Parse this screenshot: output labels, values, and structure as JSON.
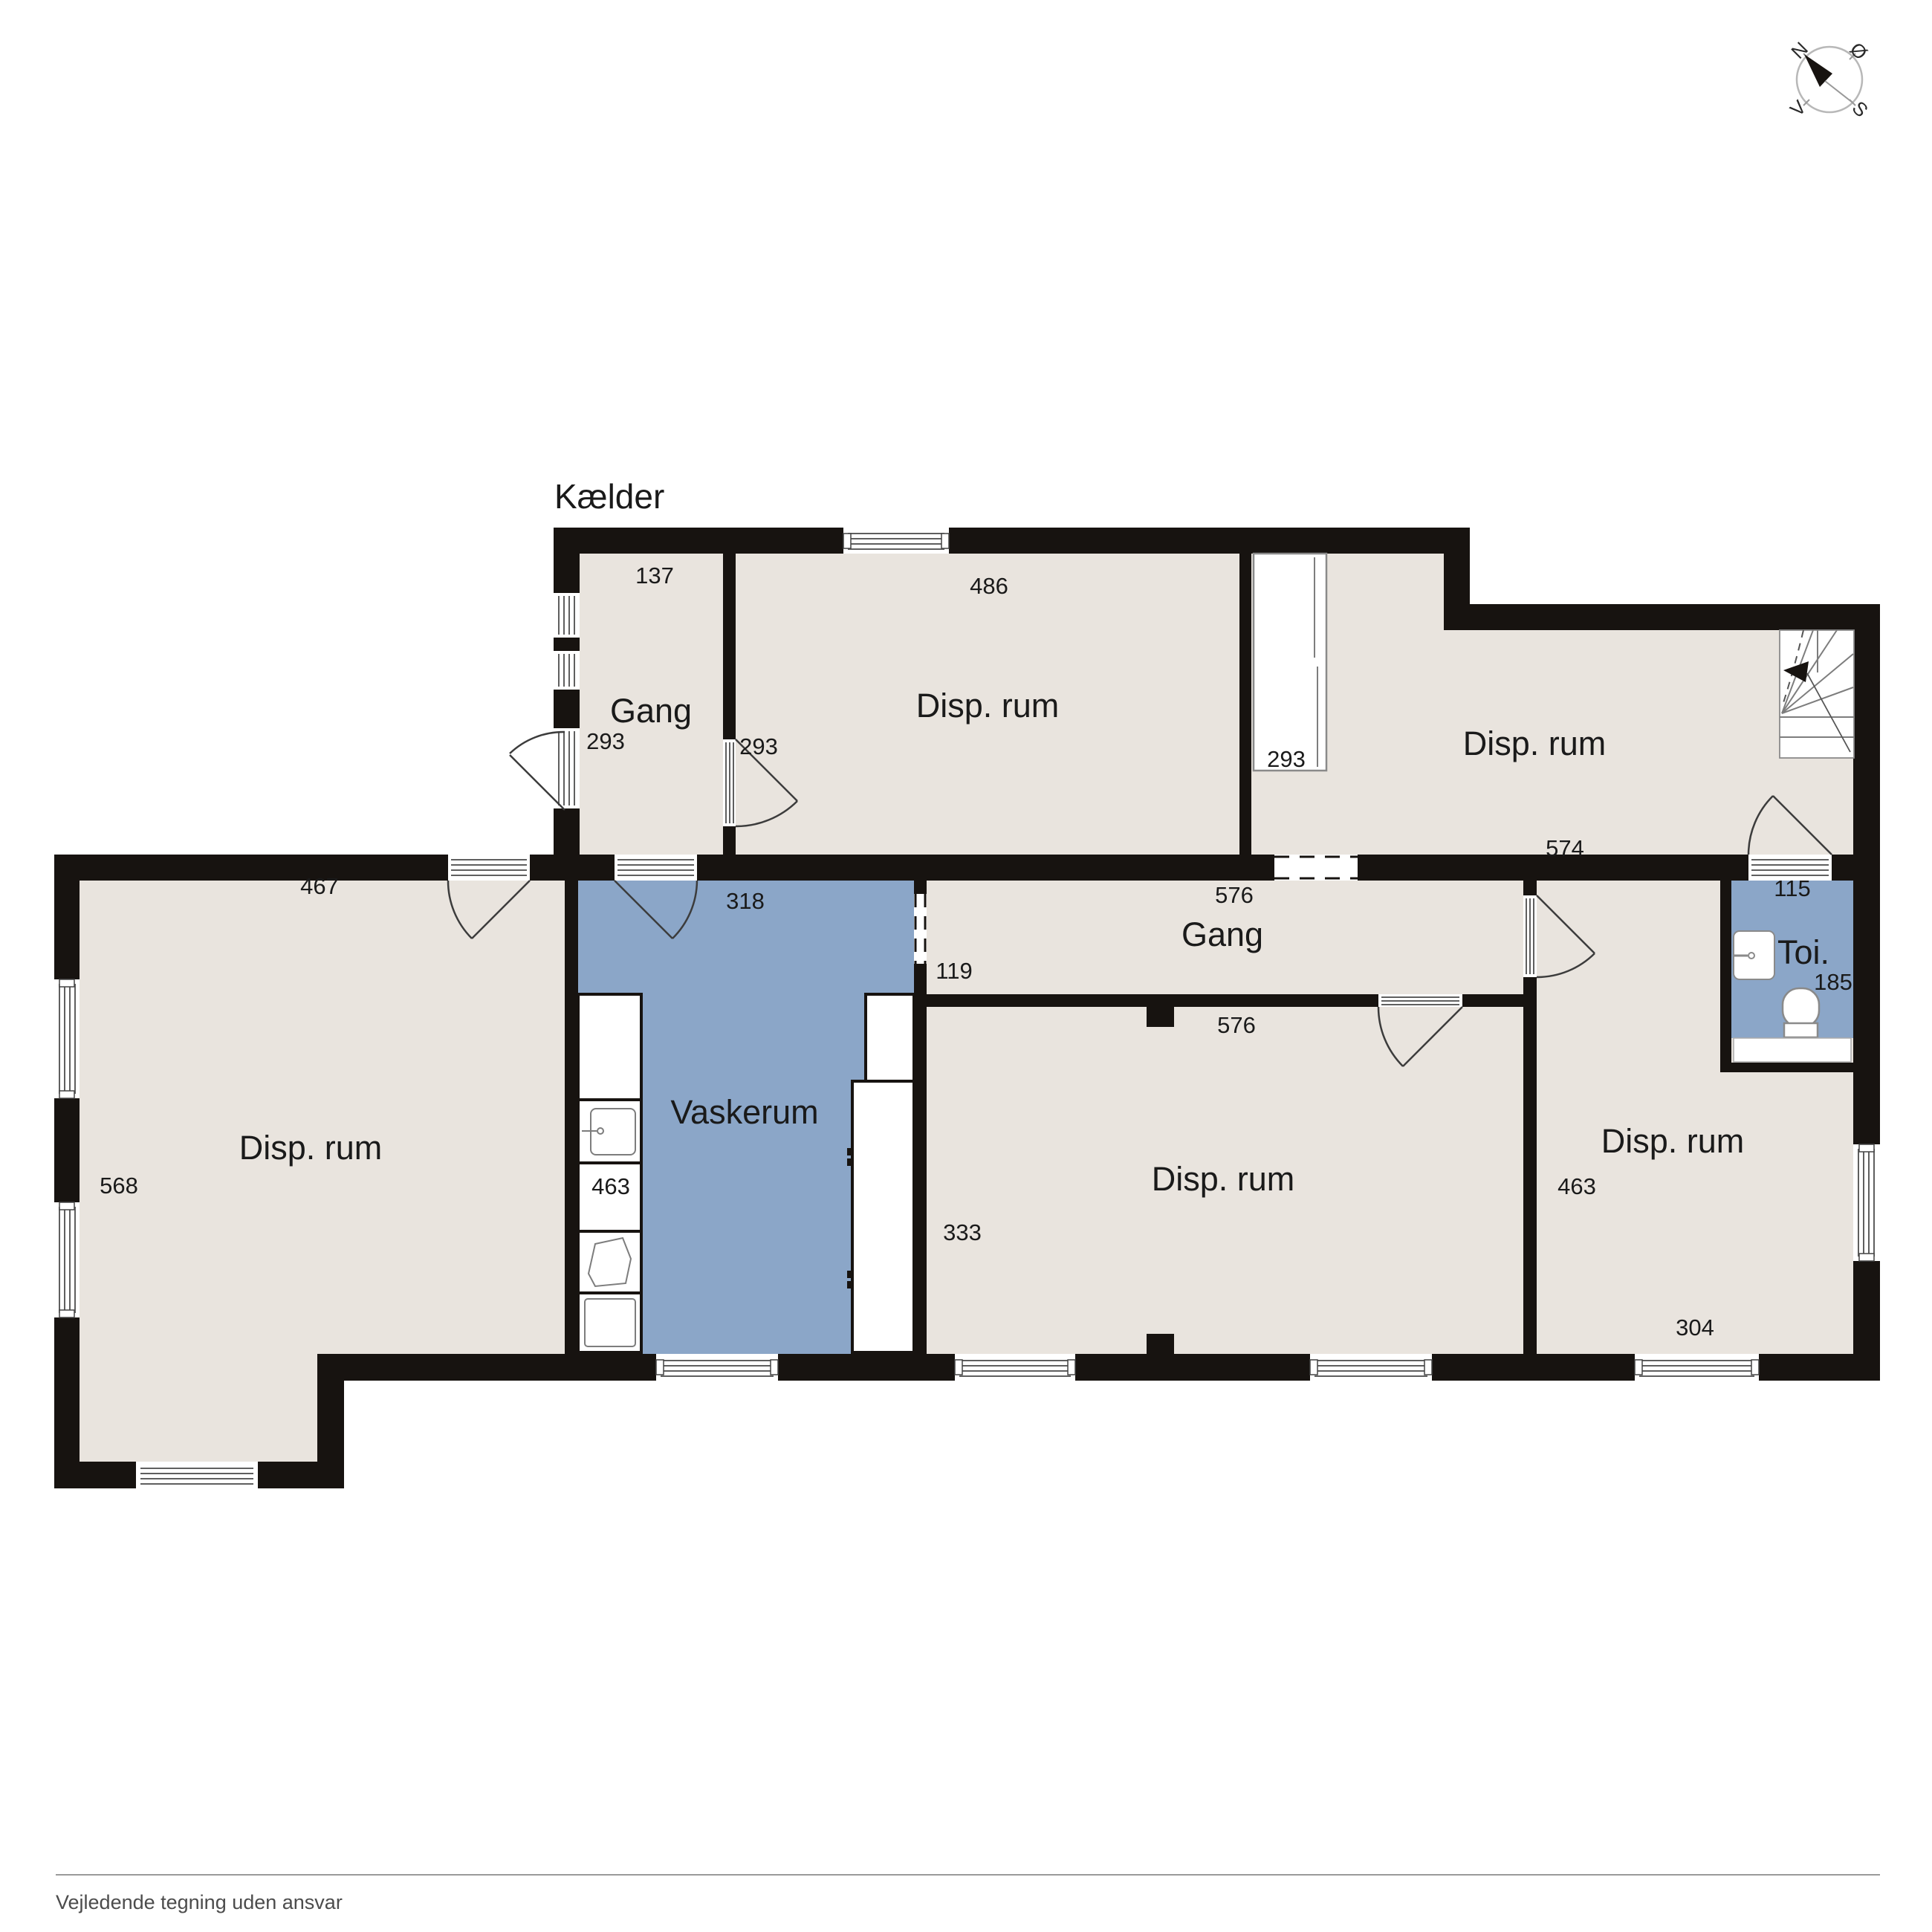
{
  "title": "Kælder",
  "compass": {
    "north": "N",
    "east": "Ø",
    "west": "V",
    "south": "S"
  },
  "rooms": {
    "gang_top": {
      "name": "Gang",
      "dim_width": "137",
      "dim_depth": "293"
    },
    "disp_top_center": {
      "name": "Disp. rum",
      "dim_width": "486",
      "dim_depth": "293"
    },
    "disp_top_right": {
      "name": "Disp. rum",
      "dim_depth": "293",
      "dim_width": "574"
    },
    "gang_mid": {
      "name": "Gang",
      "dim_width_top": "576",
      "dim_depth": "119",
      "dim_width_bottom": "576"
    },
    "vaskerum": {
      "name": "Vaskerum",
      "dim_width": "318",
      "dim_depth": "463"
    },
    "disp_left": {
      "name": "Disp. rum",
      "dim_width": "467",
      "dim_depth": "568"
    },
    "disp_bottom_center": {
      "name": "Disp. rum",
      "dim_depth": "333"
    },
    "disp_bottom_right": {
      "name": "Disp. rum",
      "dim_depth": "463",
      "dim_width": "304"
    },
    "toi": {
      "name": "Toi.",
      "dim_width": "115",
      "dim_depth": "185"
    }
  },
  "footer": {
    "disclaimer": "Vejledende tegning uden ansvar"
  },
  "icons": {
    "compass": "compass-rose",
    "stairs": "staircase",
    "toilet": "toilet",
    "sink": "sink",
    "washer": "washing-machine"
  },
  "colors": {
    "floor": "#e9e4de",
    "wet_room": "#8ba6c8",
    "wall": "#171310",
    "text": "#1a1a1a",
    "footer_text": "#4c4c4c"
  }
}
